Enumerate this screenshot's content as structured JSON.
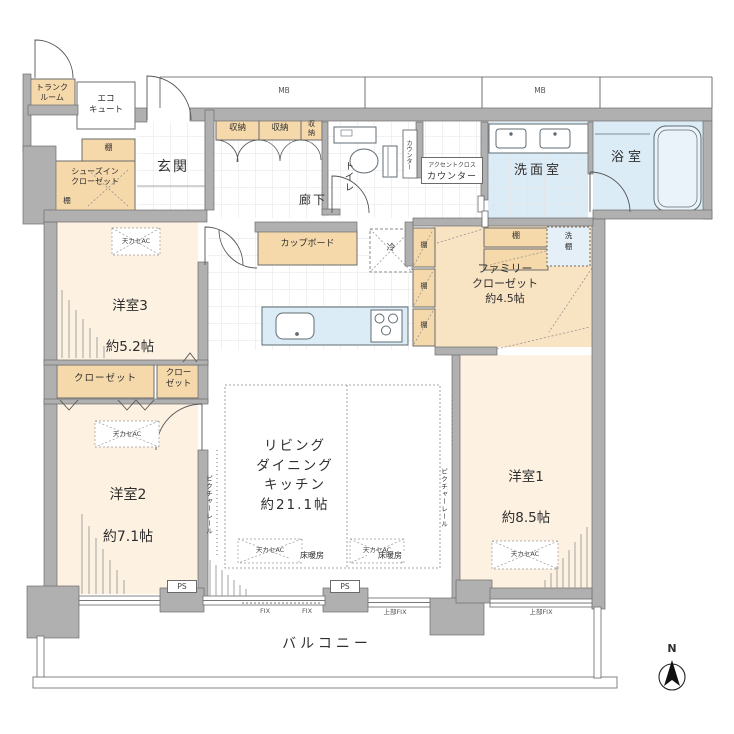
{
  "colors": {
    "wall": "#b0b0b0",
    "room_cream": "#fdf1e1",
    "storage_tan": "#f6d9ab",
    "family_closet_tan": "#f8e3c3",
    "water_blue": "#dcecf6"
  },
  "rooms": {
    "trunk_room": {
      "label": "トランク\nルーム"
    },
    "eco_cute": {
      "label": "エコ\nキュート"
    },
    "shoes_closet": {
      "label": "シューズイン\nクローゼット"
    },
    "entrance": {
      "label": "玄関"
    },
    "corridor": {
      "label": "廊下"
    },
    "toilet": {
      "label": "トイレ"
    },
    "toilet_counter": {
      "label": "カウンター"
    },
    "accent_counter": {
      "line1": "アクセントクロス",
      "line2": "カウンター"
    },
    "washroom": {
      "label": "洗面室"
    },
    "bathroom": {
      "label": "浴室"
    },
    "cupboard": {
      "label": "カップボード"
    },
    "refrigerator": {
      "label": "冷"
    },
    "bedroom3": {
      "name": "洋室3",
      "size": "約5.2帖"
    },
    "bedroom2": {
      "name": "洋室2",
      "size": "約7.1帖"
    },
    "bedroom1": {
      "name": "洋室1",
      "size": "約8.5帖"
    },
    "ldk": {
      "label": "リビング\nダイニング\nキッチン\n約21.1帖"
    },
    "family_closet": {
      "label": "ファミリー\nクローゼット\n約4.5帖"
    },
    "balcony": {
      "label": "バルコニー"
    }
  },
  "labels": {
    "shelf": "棚",
    "storage": "収納",
    "storage_vertical": "収\n納",
    "closet": "クローゼット",
    "closet_two_line": "クロー\nゼット",
    "ceiling_ac": "天カセAC",
    "floor_heating": "床暖房",
    "picture_rail": "ピクチャーレール",
    "washer_shelf": "洗\n棚",
    "meter_box": "MB",
    "pipe_space": "PS",
    "fix": "FIX",
    "upper_fix": "上部FIX",
    "north": "N"
  }
}
